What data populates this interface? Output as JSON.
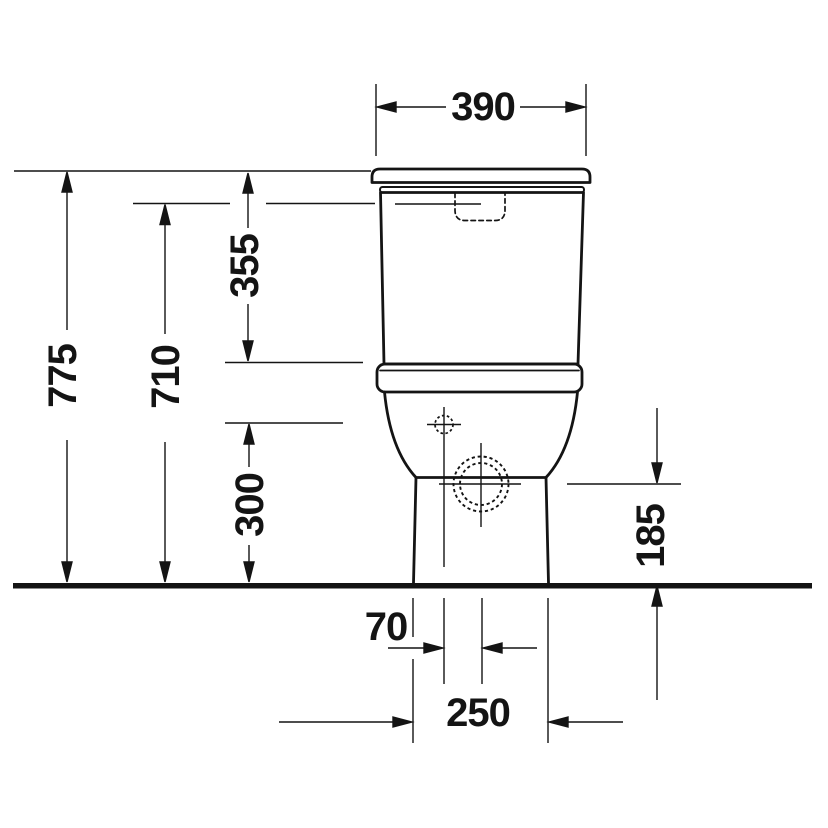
{
  "drawing": {
    "kind": "technical-dimension-drawing",
    "subject": "close-coupled-toilet-front-elevation",
    "colors": {
      "ink": "#141414",
      "background": "#ffffff"
    },
    "dimension_labels": {
      "width_top": "390",
      "height_overall": "775",
      "height_flush": "710",
      "height_cistern": "355",
      "height_inlet": "300",
      "height_outlet": "185",
      "offset_outlet": "70",
      "width_base": "250"
    }
  }
}
